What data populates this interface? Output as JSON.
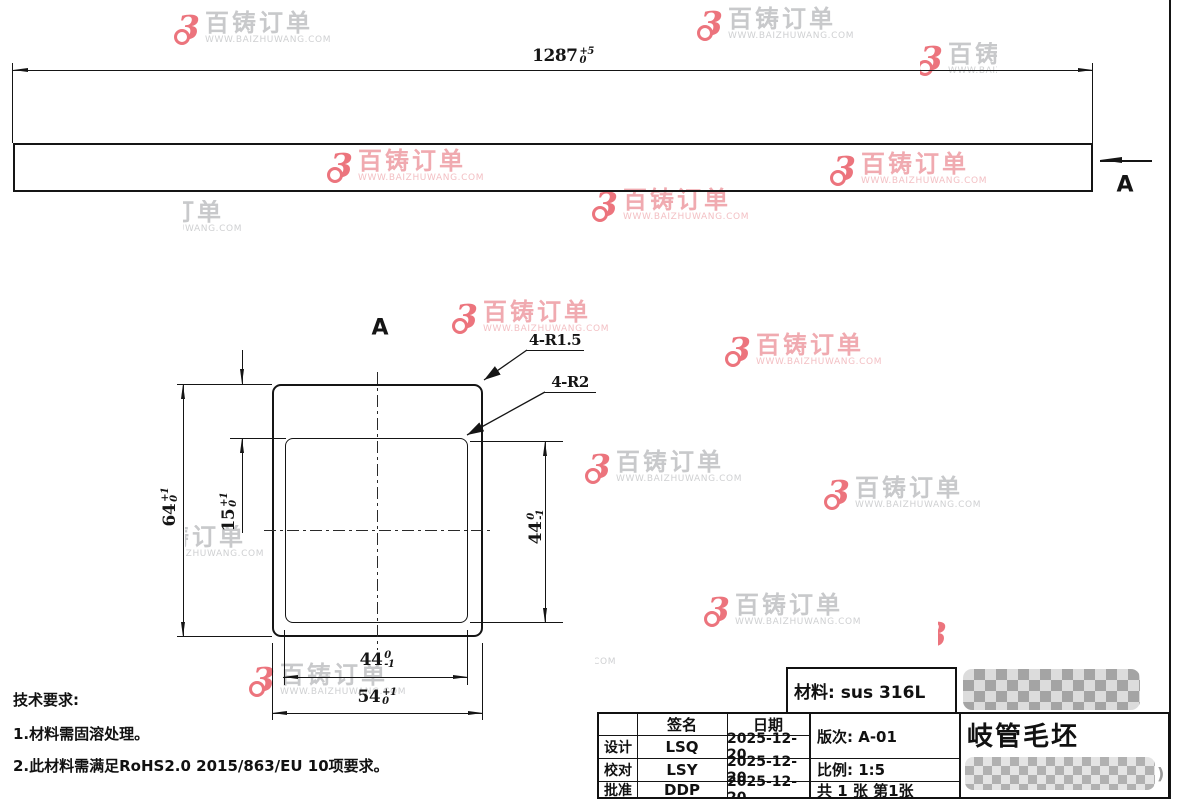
{
  "watermark": {
    "brand": "百铸订单",
    "url": "WWW.BAIZHUWANG.COM",
    "logo_glyph": "3",
    "logo_color": "#ec747d",
    "gray_text_color": "#c8c9cb",
    "pink_text_color": "#f0aab0"
  },
  "line_color": "#151515",
  "top_view": {
    "length_dim": {
      "value": "1287",
      "tol_up": "+5",
      "tol_down": "0"
    },
    "section_label": "A"
  },
  "section_view": {
    "view_label": "A",
    "callout_outer_radius": "4-R1.5",
    "callout_inner_radius": "4-R2",
    "dim_outer_height": {
      "value": "64",
      "tol_up": "+1",
      "tol_down": "0"
    },
    "dim_top_wall": {
      "value": "15",
      "tol_up": "+1",
      "tol_down": "0"
    },
    "dim_inner_height": {
      "value": "44",
      "tol_up": "0",
      "tol_down": "-1"
    },
    "dim_inner_width": {
      "value": "44",
      "tol_up": "0",
      "tol_down": "-1"
    },
    "dim_outer_width": {
      "value": "54",
      "tol_up": "+1",
      "tol_down": "0"
    }
  },
  "tech_requirements": {
    "title": "技术要求:",
    "item1": "1.材料需固溶处理。",
    "item2": "2.此材料需满足RoHS2.0 2015/863/EU 10项要求。"
  },
  "title_block": {
    "material": "材料: sus 316L",
    "part_name": "岐管毛坯",
    "revision": "版次: A-01",
    "scale": "比例: 1:5",
    "sheet": "共 1 张 第1张",
    "sign_header": "签名",
    "date_header": "日期",
    "redacted_suffix": ")",
    "rows": [
      {
        "role": "设计",
        "sign": "LSQ",
        "date": "2025-12-20"
      },
      {
        "role": "校对",
        "sign": "LSY",
        "date": "2025-12-20"
      },
      {
        "role": "批准",
        "sign": "DDP",
        "date": "2025-12-20"
      }
    ]
  }
}
